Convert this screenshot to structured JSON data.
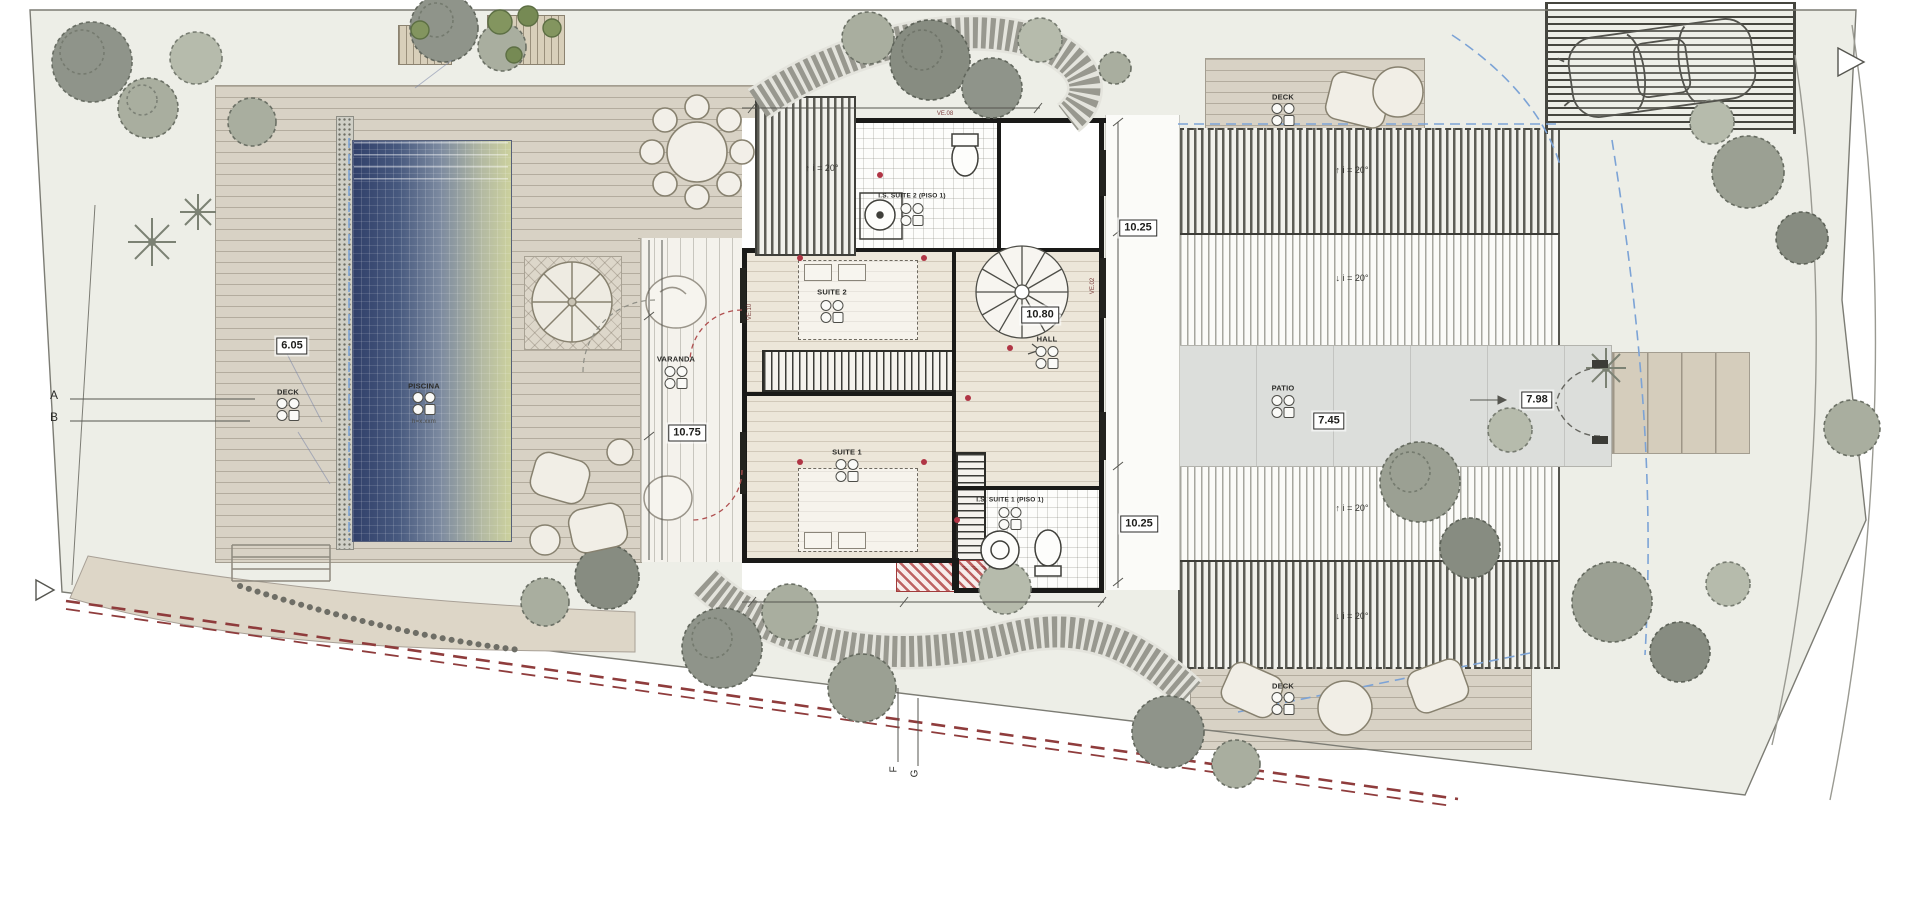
{
  "plan": {
    "labels": {
      "piscina": "PISCINA",
      "pool_depth": "h=x.xxm",
      "deck": "DECK",
      "varanda": "VARANDA",
      "suite2": "SUITE 2",
      "suite1": "SUITE 1",
      "is_suite2": "I.S. SUITE 2 (PISO 1)",
      "is_suite1": "I.S. SUITE 1 (PISO 1)",
      "hall": "HALL",
      "patio": "PATIO"
    },
    "dims": {
      "pool_deck_width": "6.05",
      "varanda_length": "10.75",
      "hall_depth": "10.80",
      "walkway_top": "10.25",
      "walkway_bottom": "10.25",
      "patio_width": "7.45",
      "entry_width": "7.98"
    },
    "slope_label": "i = 20°",
    "icons": {
      "up": "↑",
      "down": "↓",
      "arrow_right": "→"
    },
    "section_markers": {
      "a": "A",
      "b": "B",
      "f": "F",
      "g": "G"
    },
    "window_codes": {
      "ve02": "VE.02",
      "ve08": "VE.08",
      "ve10": "VE.10"
    },
    "colors": {
      "site": "#edeee7",
      "pool_deep": "#31406a",
      "pool_shallow": "#ccd19e",
      "wood": "#d8d2c5",
      "boundary_red": "#8f3c3c",
      "guide_blue": "#7ca3d6"
    }
  }
}
